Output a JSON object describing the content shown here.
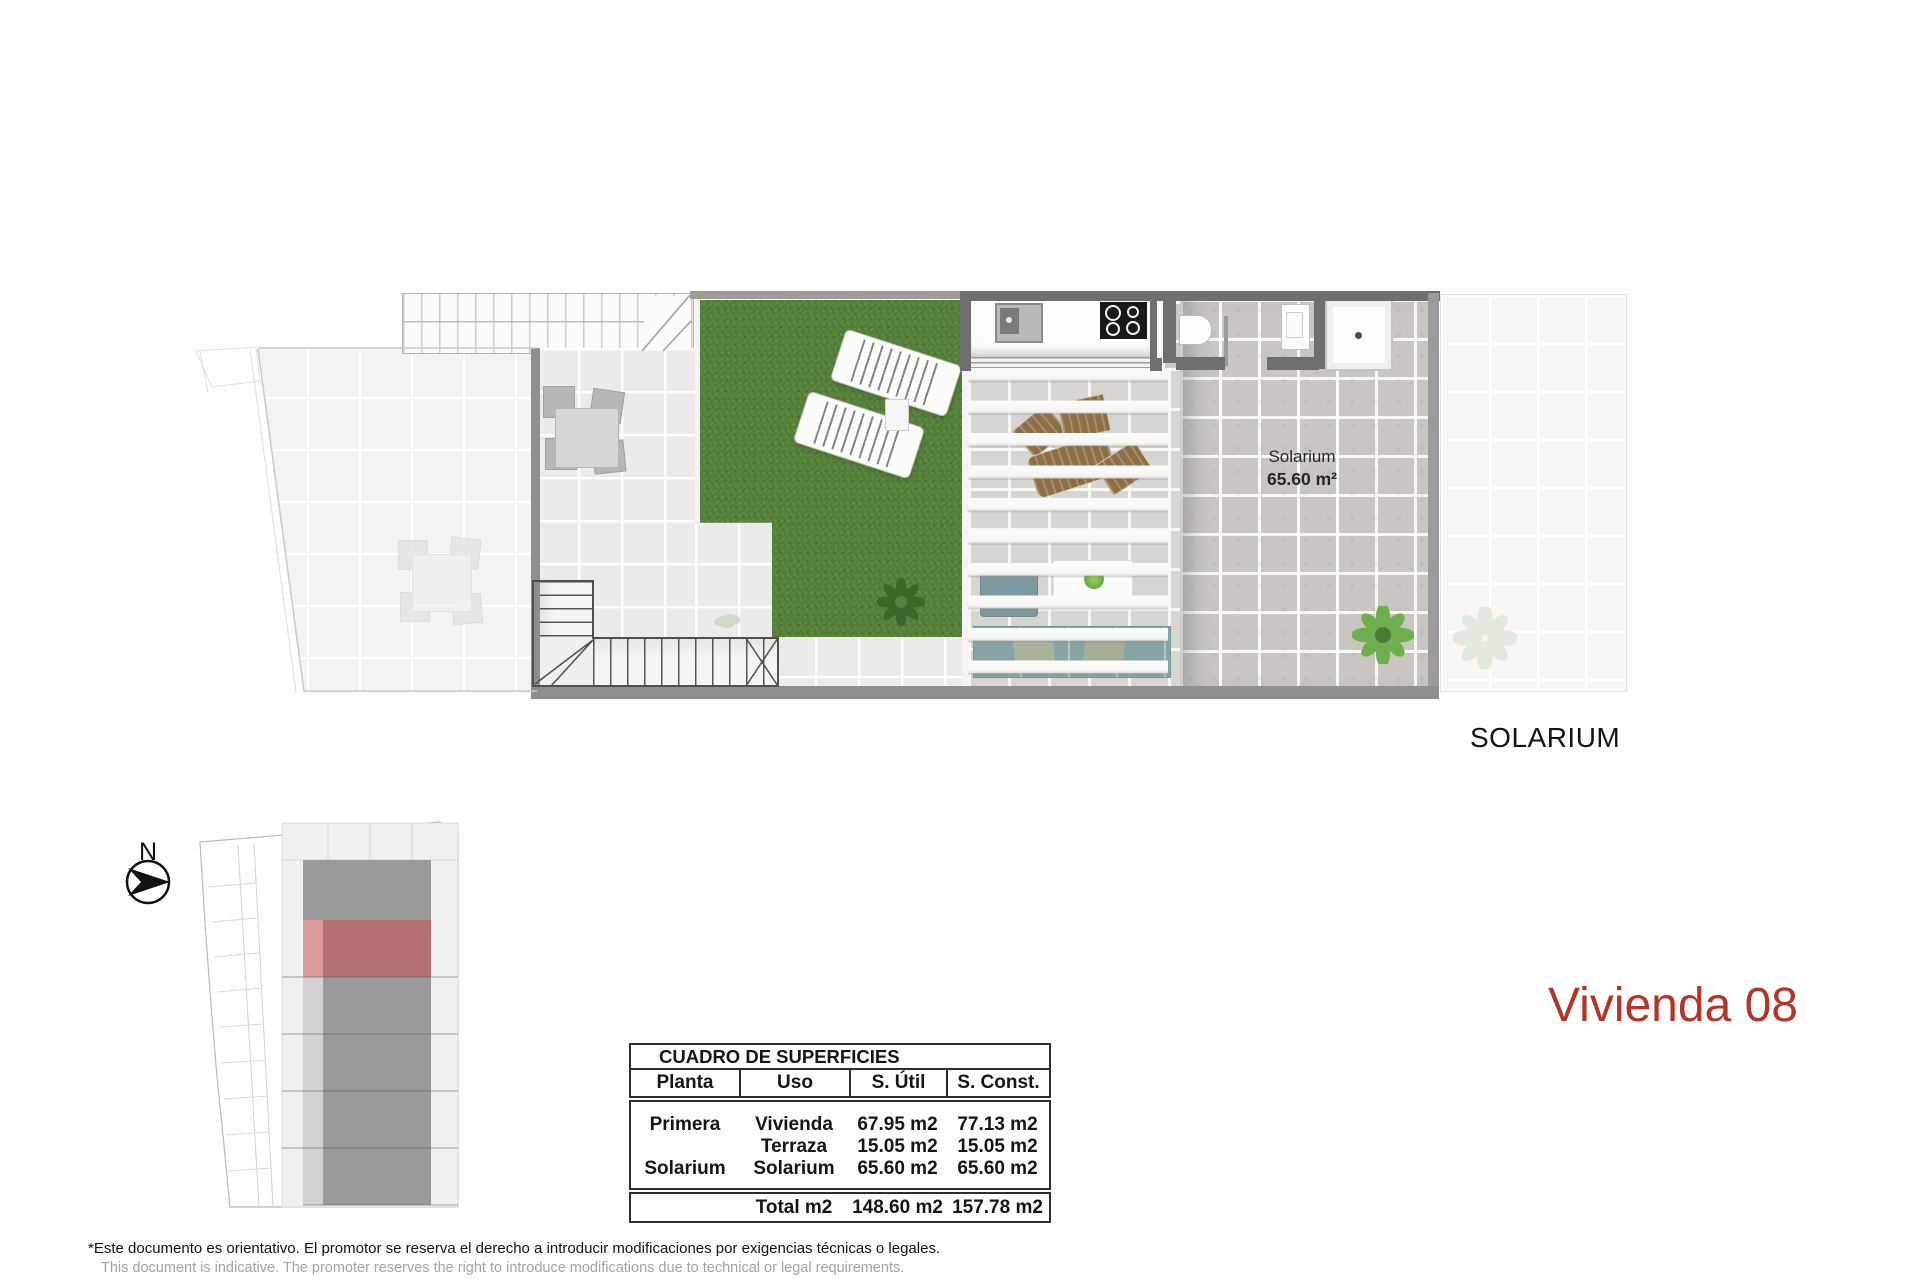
{
  "meta": {
    "section_label": "SOLARIUM",
    "title": "Vivienda 08"
  },
  "plan": {
    "solarium_label_line1": "Solarium",
    "solarium_label_line2": "65.60 m²"
  },
  "keyplan": {
    "north_label": "N"
  },
  "table": {
    "title": "CUADRO DE SUPERFICIES",
    "headers": [
      "Planta",
      "Uso",
      "S. Útil",
      "S. Const."
    ],
    "rows": [
      [
        "Primera",
        "Vivienda",
        "67.95 m2",
        "77.13 m2"
      ],
      [
        "",
        "Terraza",
        "15.05 m2",
        "15.05 m2"
      ],
      [
        "Solarium",
        "Solarium",
        "65.60 m2",
        "65.60 m2"
      ]
    ],
    "total_row": [
      "",
      "Total m2",
      "148.60 m2",
      "157.78 m2"
    ]
  },
  "disclaimer": {
    "es": "*Este documento es orientativo. El promotor se reserva el derecho a introducir modificaciones por exigencias técnicas o legales.",
    "en": "This document is indicative. The promoter reserves the right to introduce modifications due to technical or legal requirements."
  },
  "colors": {
    "accent_red": "#b43428",
    "unit_highlight_dark": "#b57070",
    "unit_highlight_light": "#dc9a9a",
    "grass_green": "#56813a",
    "wall_grey": "#6f6f6f",
    "solarium_tile": "#c9c6c1"
  }
}
